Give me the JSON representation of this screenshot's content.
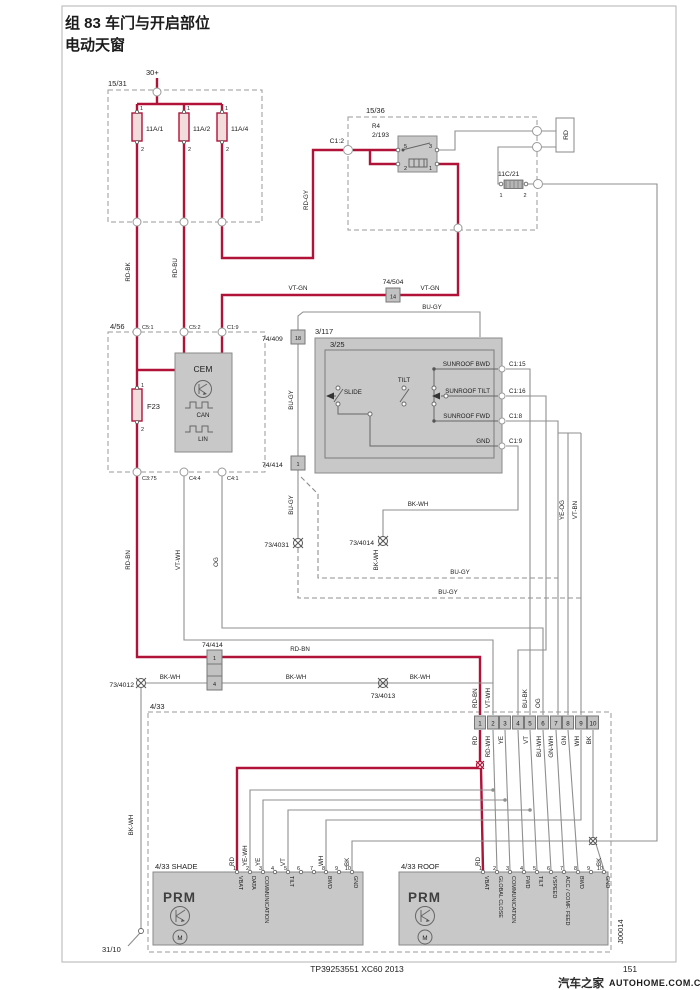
{
  "colors": {
    "wire_red": "#b01238",
    "wire_gray": "#8f8f8f",
    "box_fill": "#c8c8c8"
  },
  "title": {
    "line1": "组 83 车门与开启部位",
    "line2": "电动天窗"
  },
  "power": {
    "supply": "30+",
    "ground_point": "31/10"
  },
  "pins12": {
    "p1": "1",
    "p2": "2"
  },
  "box15_31": {
    "label": "15/31",
    "fuse1": "11A/1",
    "fuse2": "11A/2",
    "fuse3": "11A/4"
  },
  "box15_36": {
    "label": "15/36",
    "relay_name": "R4",
    "relay_id": "2/193",
    "conn": "C1:2",
    "p5": "5",
    "p3": "3",
    "p2": "2",
    "p1": "1",
    "wire_tag": "RD",
    "fuse": {
      "label": "11C/21"
    }
  },
  "conns": {
    "c74504": {
      "label": "74/504",
      "pin": "14"
    },
    "c74409": {
      "label": "74/409",
      "pin": "18"
    },
    "c74414": {
      "label": "74/414",
      "pin1": "1",
      "pin4": "4"
    }
  },
  "cem": {
    "box_label": "4/56",
    "name": "CEM",
    "fuse": "F23",
    "bus1": "CAN",
    "bus2": "LIN",
    "c51": "C5:1",
    "c52": "C5:2",
    "c19": "C1:9",
    "c375": "C3:75",
    "c44": "C4:4",
    "c41": "C4:1"
  },
  "sw": {
    "box_label": "3/117",
    "unit_label": "3/25",
    "slide": "SLIDE",
    "tilt": "TILT",
    "row1": {
      "name": "SUNROOF BWD",
      "conn": "C1:15"
    },
    "row2": {
      "name": "SUNROOF TILT",
      "conn": "C1:16"
    },
    "row3": {
      "name": "SUNROOF FWD",
      "conn": "C1:8"
    },
    "row4": {
      "name": "GND",
      "conn": "C1:9"
    }
  },
  "grounds": {
    "g12": "73/4012",
    "g13": "73/4013",
    "g31": "73/4031",
    "g14": "73/4014"
  },
  "wires": {
    "rd_bk": "RD-BK",
    "rd_bu": "RD-BU",
    "rd_gy": "RD-GY",
    "vt_gn": "VT-GN",
    "bu_gy": "BU-GY",
    "bk_wh": "BK-WH",
    "rd_bn": "RD-BN",
    "vt_wh": "VT-WH",
    "og": "OG",
    "ye_og": "YE-OG",
    "vt_bn": "VT-BN",
    "bu_bk": "BU-BK",
    "rd": "RD",
    "rd_wh": "RD-WH",
    "ye": "YE",
    "ye_wh": "YE-WH",
    "vt": "VT",
    "bu_wh": "BU-WH",
    "gn_wh": "GN-WH",
    "gn": "GN",
    "wh": "WH",
    "bk": "BK"
  },
  "strip": {
    "box_label": "4/33",
    "pins": [
      "1",
      "2",
      "3",
      "4",
      "5",
      "6",
      "7",
      "8",
      "9",
      "10"
    ]
  },
  "shade": {
    "label": "4/33 SHADE",
    "name": "PRM",
    "motor": "M",
    "funcs": {
      "p1": "VBAT",
      "p2": "DATA",
      "p3": "COMMUNICATION",
      "p5": "TILT",
      "p8": "BWD",
      "p10": "GND"
    }
  },
  "roof": {
    "label": "4/33 ROOF",
    "name": "PRM",
    "motor": "M",
    "funcs": {
      "p1": "VBAT",
      "p2": "GLOBAL CLOSE",
      "p3": "COMMUNICATION",
      "p4": "FWD",
      "p5": "TILT",
      "p6": "VSPEED",
      "p7": "ACC / COMF. FEED",
      "p8": "BWD",
      "p10": "GND"
    }
  },
  "footer": {
    "part_number": "TP39253551 XC60 2013",
    "page": "151",
    "watermark_cn": "汽车之家",
    "watermark_en": "AUTOHOME.COM.CN",
    "drawing_code": "J00014"
  }
}
